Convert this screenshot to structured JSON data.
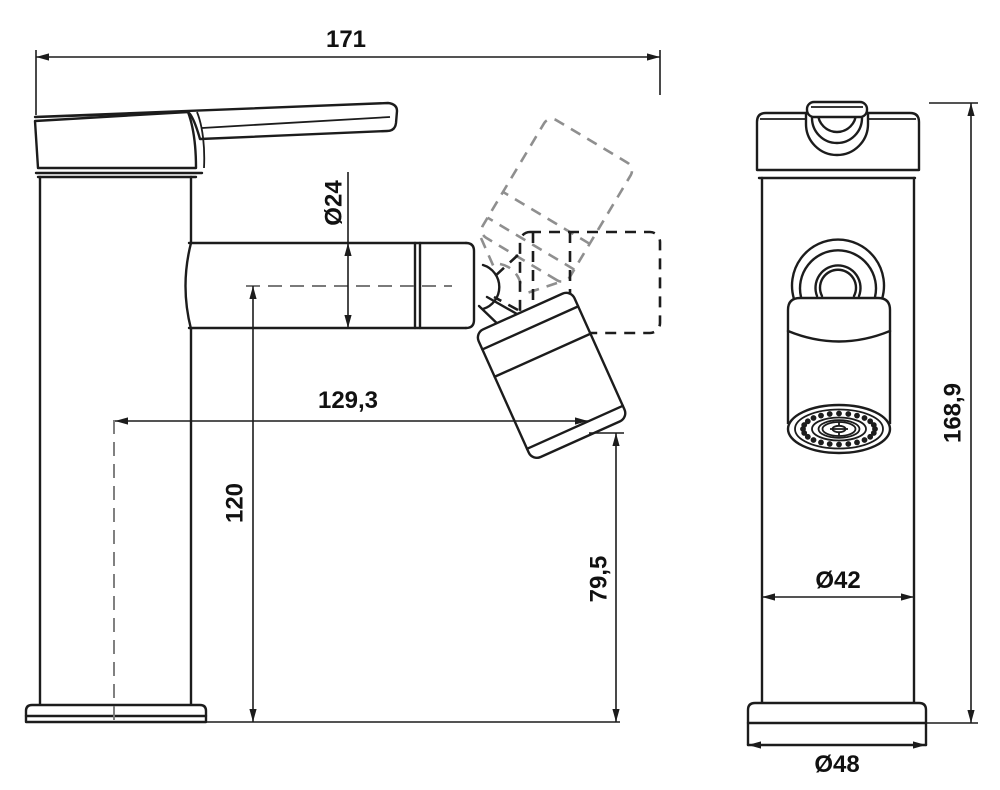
{
  "views": {
    "side": {
      "dims": {
        "total_length": "171",
        "spout_diameter": "Ø24",
        "reach": "129,3",
        "spout_height": "120",
        "outlet_height": "79,5"
      }
    },
    "front": {
      "dims": {
        "total_height": "168,9",
        "body_diameter": "Ø42",
        "base_diameter": "Ø48"
      }
    }
  }
}
